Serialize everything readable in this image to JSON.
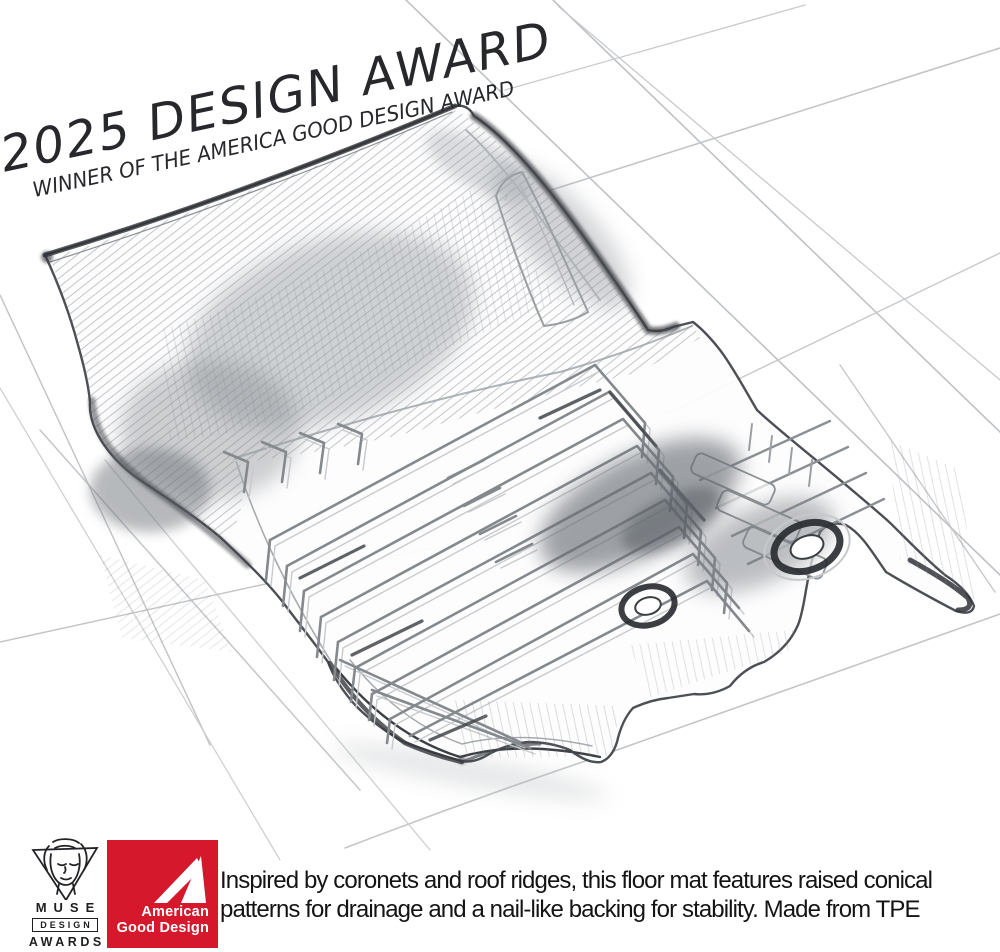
{
  "award_banner": {
    "title": "2025 DESIGN AWARD",
    "subtitle": "WINNER OF THE AMERICA GOOD DESIGN AWARD"
  },
  "footer": {
    "muse_logo": {
      "name": "MUSE",
      "line2": "DESIGN",
      "line3": "AWARDS"
    },
    "agd_logo": {
      "line1": "American",
      "line2": "Good Design",
      "color": "#D5182C"
    },
    "caption": {
      "line1": "Inspired by coronets and roof ridges, this floor mat features raised conical",
      "line2": "patterns for drainage and a nail-like backing for stability. Made from TPE"
    }
  }
}
